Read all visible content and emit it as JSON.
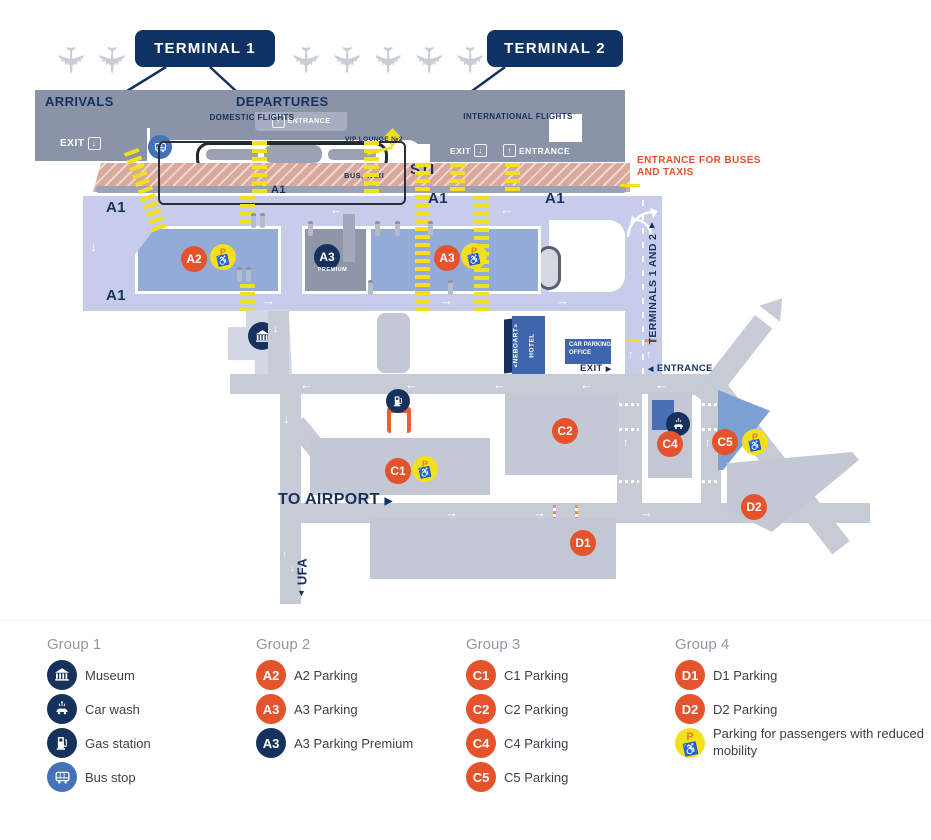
{
  "colors": {
    "navy": "#16325c",
    "badge_navy": "#0e3263",
    "orange": "#e4532c",
    "yellow": "#f2df1d",
    "terminal_gray": "#8b93a9",
    "road_gray": "#c7cbd6",
    "periwinkle": "#c6cce9",
    "lot_blue": "#92acd7",
    "salmon": "#d8a99c",
    "bus_blue": "#4472b8"
  },
  "icons": {
    "plane": "✈",
    "wheelchair": "♿",
    "arrow_up": "↑",
    "arrow_down": "↓",
    "arrow_left": "←",
    "arrow_right": "→",
    "tri_right": "▶",
    "tri_left": "◀",
    "tri_up": "▲",
    "tri_down": "▼"
  },
  "map": {
    "terminal1": "TERMINAL 1",
    "terminal2": "TERMINAL 2",
    "arrivals": "ARRIVALS",
    "departures": "DEPARTURES",
    "domestic_flights": "DOMESTIC FLIGHTS",
    "international_flights": "INTERNATIONAL FLIGHTS",
    "entrance": "ENTRANCE",
    "exit": "EXIT",
    "vip_lounge": "VIP LOUNGE №2",
    "bus_taxi": "BUS, TAXI",
    "sti": "STI",
    "entrance_for_buses": "ENTRANCE FOR BUSES AND TAXIS",
    "a1": "A1",
    "terminals_1_2": "TERMINALS 1 AND 2",
    "hotel_name": "«NEBOART»",
    "hotel_word": "HOTEL",
    "car_parking_office": "CAR PARKING OFFICE",
    "premium": "PREMIUM",
    "to_airport": "TO AIRPORT",
    "ufa": "UFA",
    "p": "P",
    "markers": {
      "a2": "A2",
      "a3": "A3",
      "a3_premium": "A3",
      "c1": "C1",
      "c2": "C2",
      "c4": "C4",
      "c5": "C5",
      "d1": "D1",
      "d2": "D2"
    }
  },
  "legend": {
    "groups": [
      {
        "title": "Group 1",
        "items": [
          {
            "label": "Museum"
          },
          {
            "label": "Car wash"
          },
          {
            "label": "Gas station"
          },
          {
            "label": "Bus stop"
          }
        ]
      },
      {
        "title": "Group 2",
        "items": [
          {
            "badge": "A2",
            "label": "A2 Parking"
          },
          {
            "badge": "A3",
            "label": "A3 Parking"
          },
          {
            "badge": "A3",
            "label": "A3 Parking Premium"
          }
        ]
      },
      {
        "title": "Group 3",
        "items": [
          {
            "badge": "C1",
            "label": "C1 Parking"
          },
          {
            "badge": "C2",
            "label": "C2 Parking"
          },
          {
            "badge": "C4",
            "label": "C4 Parking"
          },
          {
            "badge": "C5",
            "label": "C5 Parking"
          }
        ]
      },
      {
        "title": "Group 4",
        "items": [
          {
            "badge": "D1",
            "label": "D1 Parking"
          },
          {
            "badge": "D2",
            "label": "D2 Parking"
          },
          {
            "label": "Parking for passengers with reduced mobility"
          }
        ]
      }
    ]
  }
}
